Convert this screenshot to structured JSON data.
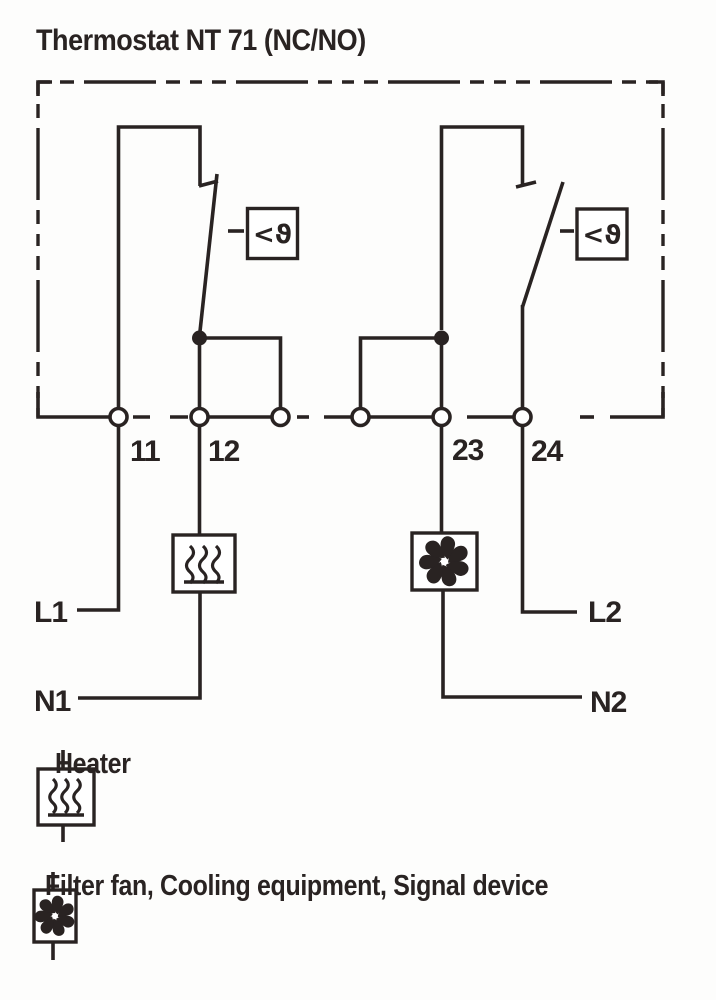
{
  "title": "Thermostat NT 71 (NC/NO)",
  "diagram": {
    "thermostat_symbol": "<ϑ",
    "terminals": {
      "t11": "11",
      "t12": "12",
      "t23": "23",
      "t24": "24"
    },
    "line_labels": {
      "l1": "L1",
      "n1": "N1",
      "l2": "L2",
      "n2": "N2"
    }
  },
  "legend": [
    {
      "symbol": "heater-symbol",
      "label": "Heater"
    },
    {
      "symbol": "fan-symbol",
      "label": "Filter fan, Cooling equipment, Signal device"
    }
  ],
  "colors": {
    "ink": "#292322",
    "background": "#fdfdfc"
  }
}
